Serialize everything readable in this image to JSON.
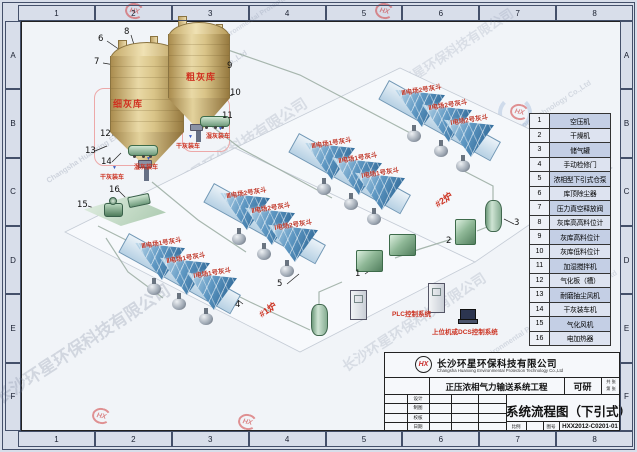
{
  "frame": {
    "cols": [
      "1",
      "2",
      "3",
      "4",
      "5",
      "6",
      "7",
      "8"
    ],
    "rows": [
      "A",
      "B",
      "C",
      "D",
      "E",
      "F"
    ]
  },
  "silos": {
    "fine": "细灰库",
    "coarse": "粗灰库",
    "dry_loading": "干灰装车",
    "wet_loading": "湿灰装车"
  },
  "hoppers": {
    "rows": [
      {
        "h": [
          "Ⅲ电场2号灰斗",
          "Ⅱ电场2号灰斗",
          "Ⅰ电场2号灰斗"
        ]
      },
      {
        "h": [
          "Ⅲ电场1号灰斗",
          "Ⅱ电场1号灰斗",
          "Ⅰ电场1号灰斗"
        ]
      },
      {
        "h": [
          "Ⅲ电场2号灰斗",
          "Ⅱ电场2号灰斗",
          "Ⅰ电场2号灰斗"
        ]
      },
      {
        "h": [
          "Ⅲ电场1号灰斗",
          "Ⅱ电场1号灰斗",
          "Ⅰ电场1号灰斗"
        ]
      }
    ]
  },
  "boilers": {
    "b1": "#1炉",
    "b2": "#2炉"
  },
  "control": {
    "plc": "PLC控制系统",
    "dcs": "上位机或DCS控制系统"
  },
  "callouts": [
    "1",
    "2",
    "3",
    "4",
    "5",
    "6",
    "7",
    "8",
    "9",
    "10",
    "11",
    "12",
    "13",
    "14",
    "15",
    "16"
  ],
  "legend": {
    "items": [
      {
        "no": "1",
        "name": "空压机"
      },
      {
        "no": "2",
        "name": "干燥机"
      },
      {
        "no": "3",
        "name": "储气罐"
      },
      {
        "no": "4",
        "name": "手动检修门"
      },
      {
        "no": "5",
        "name": "浓相型下引式仓泵"
      },
      {
        "no": "6",
        "name": "库顶除尘器"
      },
      {
        "no": "7",
        "name": "压力真空释放阀"
      },
      {
        "no": "8",
        "name": "灰库高高料位计"
      },
      {
        "no": "9",
        "name": "灰库高料位计"
      },
      {
        "no": "10",
        "name": "灰库低料位计"
      },
      {
        "no": "11",
        "name": "加湿搅拌机"
      },
      {
        "no": "12",
        "name": "气化板（槽）"
      },
      {
        "no": "13",
        "name": "耐磨抽尘风机"
      },
      {
        "no": "14",
        "name": "干灰装车机"
      },
      {
        "no": "15",
        "name": "气化风机"
      },
      {
        "no": "16",
        "name": "电加热器"
      }
    ]
  },
  "titleblock": {
    "logo": "HX",
    "company_cn": "长沙环星环保科技有限公司",
    "company_en": "Changsha Huanxing Environmental Protection Technology Co.,Ltd",
    "project": "正压浓相气力输送系统工程",
    "stage": "可研",
    "sheet_total": "共 张",
    "sheet_no": "第 张",
    "title": "系统流程图（下引式）",
    "scale_label": "比例",
    "no_label": "图号",
    "drawing_no": "HXX2012-C0201-01",
    "fields": {
      "design": "设计",
      "draft": "制图",
      "check": "校核",
      "date": "日期"
    }
  },
  "watermarks": {
    "cn": "长沙环星环保科技有限公司",
    "en": "Changsha Huanxing Environmental Protection Technology Co.,Ltd",
    "logo": "HX"
  }
}
